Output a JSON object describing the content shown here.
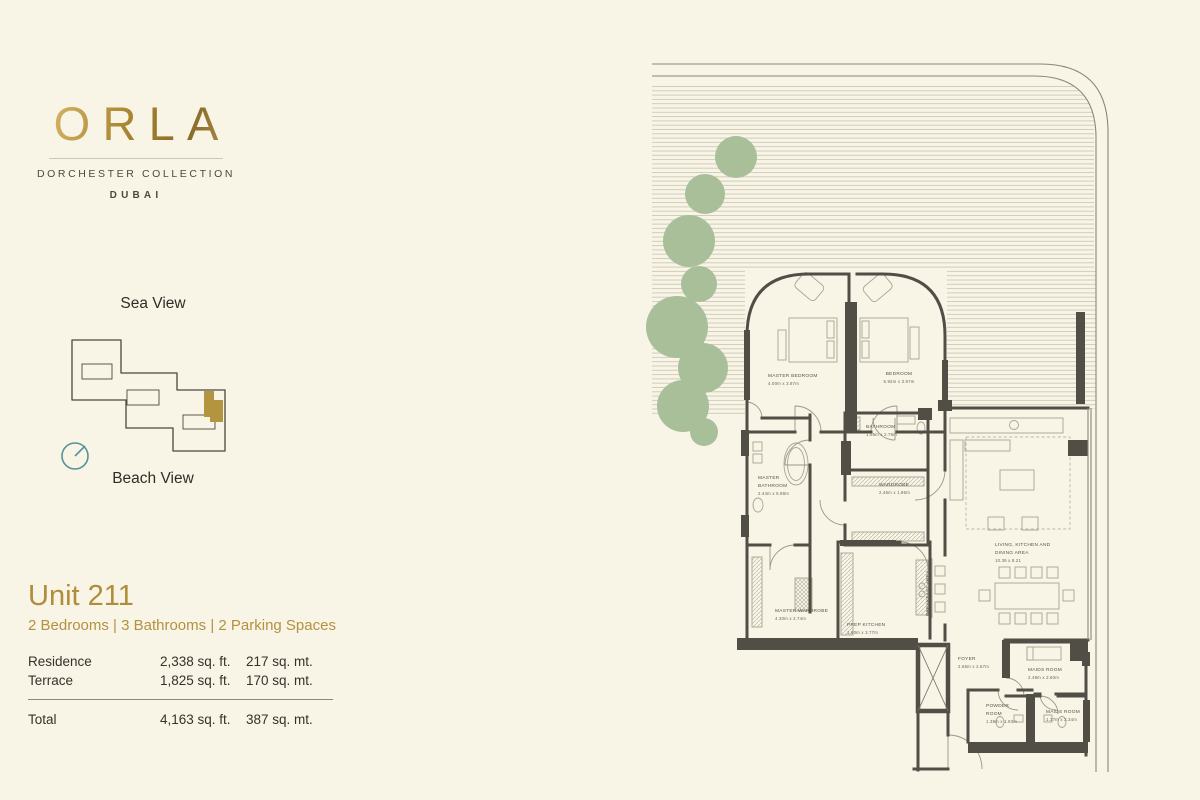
{
  "brand": {
    "logo": "ORLA",
    "collection": "DORCHESTER COLLECTION",
    "city": "DUBAI"
  },
  "keyplan": {
    "sea_label": "Sea View",
    "beach_label": "Beach View"
  },
  "unit": {
    "title": "Unit 211",
    "subtitle": "2 Bedrooms | 3 Bathrooms | 2 Parking Spaces",
    "areas": {
      "rows": [
        {
          "label": "Residence",
          "sqft": "2,338 sq. ft.",
          "sqmt": "217 sq. mt."
        },
        {
          "label": "Terrace",
          "sqft": "1,825 sq. ft.",
          "sqmt": "170 sq. mt."
        }
      ],
      "total": {
        "label": "Total",
        "sqft": "4,163 sq. ft.",
        "sqmt": "387 sq. mt."
      }
    }
  },
  "floorplan": {
    "rooms": {
      "master_bedroom": {
        "name": "MASTER BEDROOM",
        "dims": "4.00m x 3.97m"
      },
      "bedroom": {
        "name": "BEDROOM",
        "dims": "5.92m x 3.97m"
      },
      "bathroom": {
        "name": "BATHROOM",
        "dims": "1.95m x 2.78m"
      },
      "master_bathroom": {
        "line1": "MASTER",
        "line2": "BATHROOM",
        "dims": "2.44m x 5.98m"
      },
      "wardrobe": {
        "name": "WARDROBE",
        "dims": "2.46m x 1.86m"
      },
      "living": {
        "line1": "LIVING, KITCHEN AND",
        "line2": "DINING AREA",
        "dims": "10.39 x 8.21"
      },
      "master_wardrobe": {
        "name": "MASTER WARDROBE",
        "dims": "4.30m x 2.74m"
      },
      "prep_kitchen": {
        "name": "PREP KITCHEN",
        "dims": "1.60m x 3.77m"
      },
      "breakfast_area": {
        "name": "BREAKFAST AREA"
      },
      "foyer": {
        "name": "FOYER",
        "dims": "2.65m x 2.67m"
      },
      "maids_room_1": {
        "name": "MAIDS ROOM",
        "dims": "2.49m x 2.60m"
      },
      "powder_room": {
        "line1": "POWDER",
        "line2": "ROOM",
        "dims": "1.38m x 1.93m"
      },
      "maids_room_2": {
        "name": "MAIDS ROOM",
        "dims": "1.37m x 2.34m"
      }
    }
  },
  "colors": {
    "background": "#f8f4e6",
    "gold": "#b08c3b",
    "text_dark": "#3c3a31",
    "wall": "#514e45",
    "tree": "#a8bf99",
    "compass": "#579399"
  }
}
